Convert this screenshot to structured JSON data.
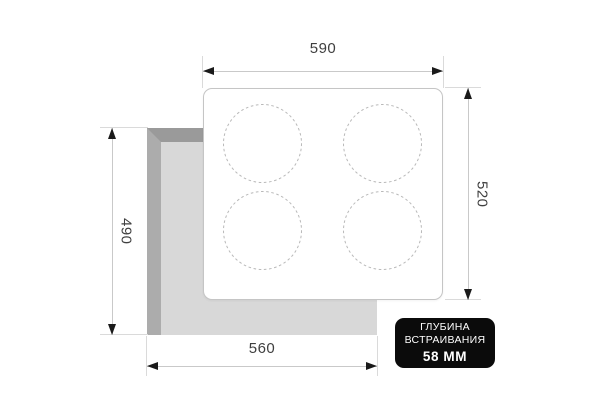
{
  "diagram": {
    "dims": {
      "top": "590",
      "right": "520",
      "left": "490",
      "bottom": "560"
    },
    "badge": {
      "line1": "ГЛУБИНА",
      "line2": "ВСТРАИВАНИЯ",
      "line3": "58 ММ"
    },
    "colors": {
      "cutout_fill": "#d8d8d8",
      "cutout_edge_top": "#9a9a9a",
      "cutout_edge_left": "#acacac",
      "panel_border": "#c5c5c5",
      "burner_dash": "#b9b9b9",
      "dimension_line": "#c9c9c9",
      "extension_line": "#dadada",
      "arrowhead": "#1a1a1a",
      "dimension_text": "#3f3f3f",
      "badge_bg": "#0b0b0b",
      "badge_text": "#ffffff"
    }
  }
}
